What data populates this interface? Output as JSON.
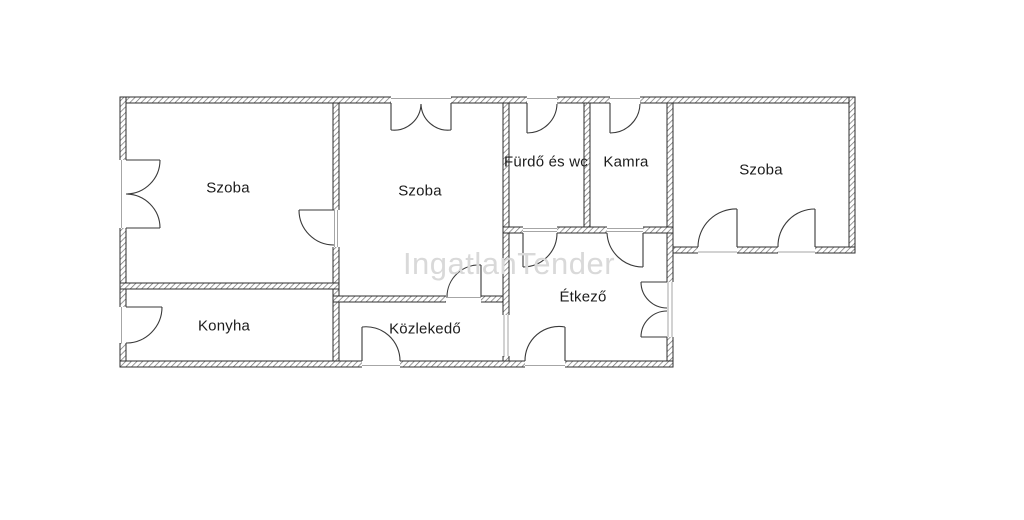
{
  "watermark": {
    "text": "IngatlanTender",
    "color": "#d9d9d9"
  },
  "colors": {
    "background": "#ffffff",
    "wall_outline": "#2e2e2e",
    "wall_hatch": "#6f6f6f",
    "door_line": "#3a3a3a",
    "label_text": "#1c1c1c"
  },
  "rooms": [
    {
      "label": "Szoba"
    },
    {
      "label": "Szoba"
    },
    {
      "label": "Fürdő és wc"
    },
    {
      "label": "Kamra"
    },
    {
      "label": "Szoba"
    },
    {
      "label": "Konyha"
    },
    {
      "label": "Közlekedő"
    },
    {
      "label": "Étkező"
    }
  ]
}
